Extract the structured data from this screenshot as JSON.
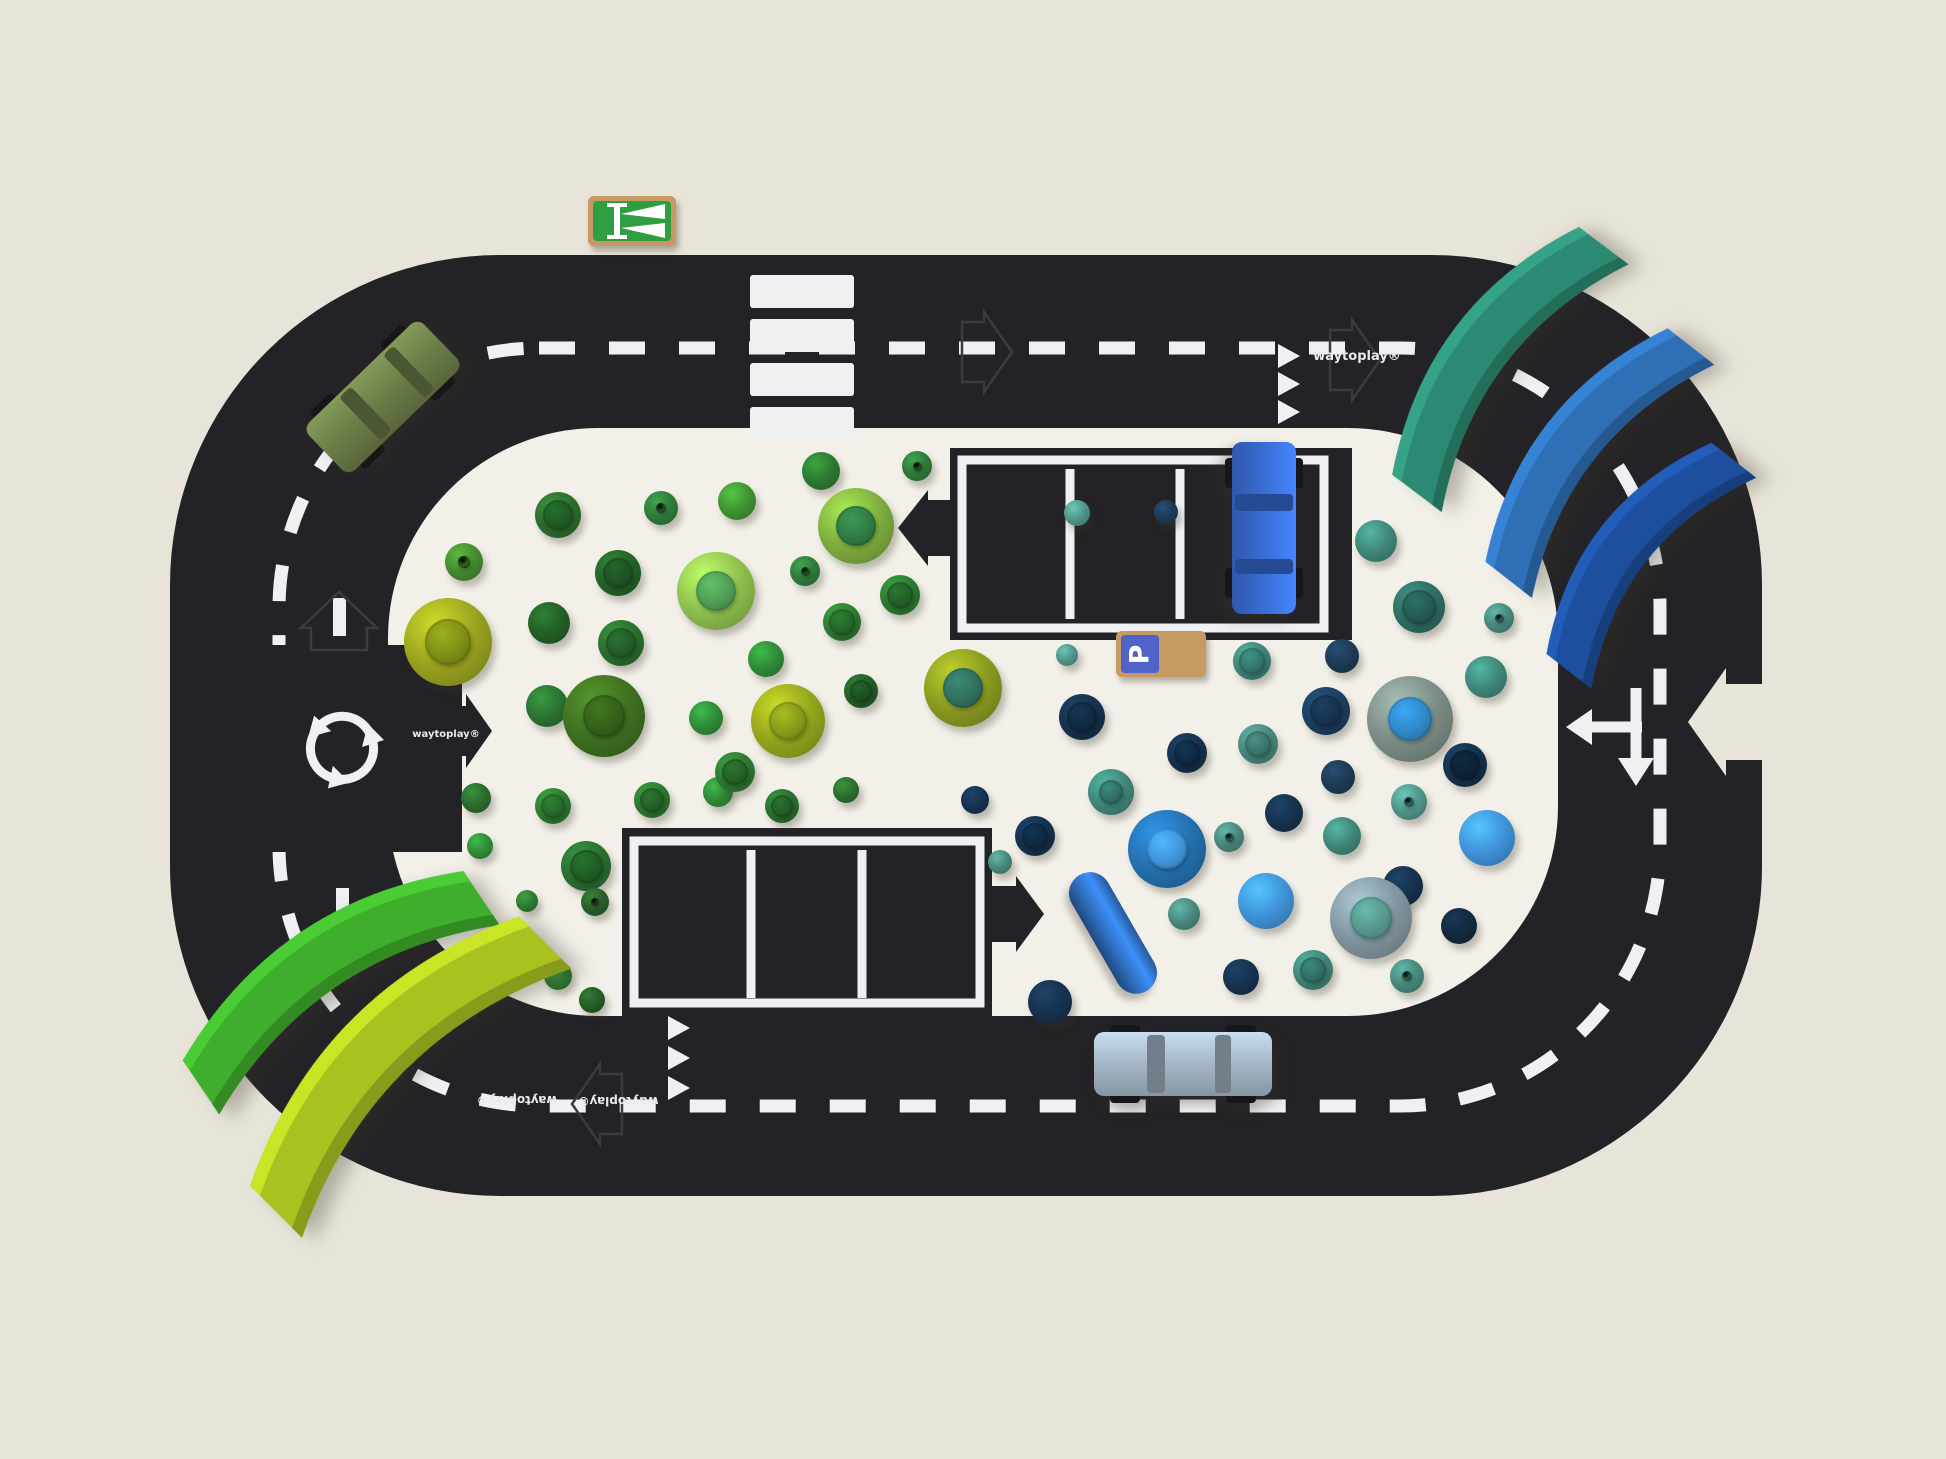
{
  "scene": {
    "background_color": "#e8e4d9",
    "mat_color": "#f2f0e8",
    "road_color": "#232327",
    "marking_color": "#eef0f2",
    "wood_color": "#c79a63"
  },
  "track": {
    "brand": "waytoplay®",
    "features": [
      "zebra-crossing",
      "roundabout",
      "t-junction-arrows",
      "give-way-triangles",
      "dashed-center-line",
      "puzzle-arrow-connectors",
      "parking-lot-top",
      "parking-lot-bottom"
    ]
  },
  "signs": {
    "motorway_sign": {
      "x": 588,
      "y": 196,
      "w": 88,
      "h": 50,
      "face": "#2f9e41"
    },
    "parking_sign": {
      "x": 1116,
      "y": 631,
      "w": 90,
      "h": 46,
      "face": "#4f63c8",
      "letter": "P"
    }
  },
  "toys": {
    "green_pieces": [
      {
        "x": 558,
        "y": 515,
        "r": 23,
        "c": "#2c6e2e",
        "cap": "#1f5a23",
        "t": "mush"
      },
      {
        "x": 661,
        "y": 508,
        "r": 17,
        "c": "#2f7a3a",
        "cap": null,
        "t": "cone"
      },
      {
        "x": 737,
        "y": 501,
        "r": 19,
        "c": "#3f9332",
        "cap": null,
        "t": "ball"
      },
      {
        "x": 821,
        "y": 471,
        "r": 19,
        "c": "#2c7a30",
        "cap": null,
        "t": "ball"
      },
      {
        "x": 856,
        "y": 526,
        "r": 38,
        "c": "#7fae3e",
        "cap": "#2f7a44",
        "t": "bowl"
      },
      {
        "x": 464,
        "y": 562,
        "r": 19,
        "c": "#458a2f",
        "cap": null,
        "t": "cone"
      },
      {
        "x": 618,
        "y": 573,
        "r": 23,
        "c": "#256328",
        "cap": "#1d5222",
        "t": "mush"
      },
      {
        "x": 716,
        "y": 591,
        "r": 39,
        "c": "#8fc04e",
        "cap": "#4f9a55",
        "t": "bowl"
      },
      {
        "x": 805,
        "y": 571,
        "r": 15,
        "c": "#2f7a3a",
        "cap": null,
        "t": "cone"
      },
      {
        "x": 842,
        "y": 622,
        "r": 19,
        "c": "#2e7d32",
        "cap": "#256628",
        "t": "mush"
      },
      {
        "x": 448,
        "y": 642,
        "r": 44,
        "c": "#9aa41f",
        "cap": "#7e8c15",
        "t": "bowl"
      },
      {
        "x": 549,
        "y": 623,
        "r": 21,
        "c": "#235f27",
        "cap": null,
        "t": "ball"
      },
      {
        "x": 621,
        "y": 643,
        "r": 23,
        "c": "#2a7030",
        "cap": "#225c28",
        "t": "mush"
      },
      {
        "x": 766,
        "y": 659,
        "r": 18,
        "c": "#2f8b38",
        "cap": null,
        "t": "ball"
      },
      {
        "x": 861,
        "y": 691,
        "r": 17,
        "c": "#235f27",
        "cap": "#1c5020",
        "t": "mush"
      },
      {
        "x": 547,
        "y": 706,
        "r": 21,
        "c": "#2a7330",
        "cap": null,
        "t": "ball"
      },
      {
        "x": 604,
        "y": 716,
        "r": 41,
        "c": "#3e7020",
        "cap": "#336018",
        "t": "bowl"
      },
      {
        "x": 706,
        "y": 718,
        "r": 17,
        "c": "#2f8b38",
        "cap": null,
        "t": "ball"
      },
      {
        "x": 788,
        "y": 721,
        "r": 37,
        "c": "#96a51d",
        "cap": "#86961a",
        "t": "bowl"
      },
      {
        "x": 900,
        "y": 595,
        "r": 20,
        "c": "#2c7a30",
        "cap": "#235f27",
        "t": "mush"
      },
      {
        "x": 917,
        "y": 466,
        "r": 15,
        "c": "#2f7a3a",
        "cap": null,
        "t": "cone"
      },
      {
        "x": 476,
        "y": 798,
        "r": 15,
        "c": "#2a6b2d",
        "cap": null,
        "t": "ball"
      },
      {
        "x": 553,
        "y": 806,
        "r": 18,
        "c": "#2e7d32",
        "cap": "#266829",
        "t": "mush"
      },
      {
        "x": 480,
        "y": 846,
        "r": 13,
        "c": "#2f8b38",
        "cap": null,
        "t": "ball"
      },
      {
        "x": 586,
        "y": 866,
        "r": 25,
        "c": "#2a7030",
        "cap": "#1f5c25",
        "t": "mush"
      },
      {
        "x": 527,
        "y": 901,
        "r": 11,
        "c": "#2c7a30",
        "cap": null,
        "t": "ball"
      },
      {
        "x": 500,
        "y": 946,
        "r": 16,
        "c": "#235f27",
        "cap": null,
        "t": "ball"
      },
      {
        "x": 558,
        "y": 976,
        "r": 14,
        "c": "#2e7d32",
        "cap": null,
        "t": "ball"
      },
      {
        "x": 462,
        "y": 1000,
        "r": 15,
        "c": "#2f7a3a",
        "cap": null,
        "t": "cone"
      },
      {
        "x": 652,
        "y": 800,
        "r": 18,
        "c": "#2c7a30",
        "cap": "#235f27",
        "t": "mush"
      },
      {
        "x": 718,
        "y": 792,
        "r": 15,
        "c": "#2f8b38",
        "cap": null,
        "t": "ball"
      },
      {
        "x": 782,
        "y": 806,
        "r": 17,
        "c": "#2a7030",
        "cap": "#225c28",
        "t": "mush"
      },
      {
        "x": 846,
        "y": 790,
        "r": 13,
        "c": "#2c6e2e",
        "cap": null,
        "t": "ball"
      },
      {
        "x": 595,
        "y": 902,
        "r": 14,
        "c": "#2a5e2a",
        "cap": null,
        "t": "cone"
      },
      {
        "x": 592,
        "y": 1000,
        "r": 13,
        "c": "#245c26",
        "cap": null,
        "t": "ball"
      },
      {
        "x": 963,
        "y": 688,
        "r": 39,
        "c": "#8c9a20",
        "cap": "#2f6e5e",
        "t": "bowl"
      },
      {
        "x": 735,
        "y": 772,
        "r": 20,
        "c": "#2c7a30",
        "cap": "#235f27",
        "t": "mush"
      }
    ],
    "blue_pieces": [
      {
        "x": 1067,
        "y": 655,
        "r": 11,
        "c": "#4f9488",
        "cap": null,
        "t": "ball"
      },
      {
        "x": 1252,
        "y": 661,
        "r": 19,
        "c": "#3f8779",
        "cap": "#34746a",
        "t": "mush"
      },
      {
        "x": 1342,
        "y": 656,
        "r": 17,
        "c": "#1d3a55",
        "cap": null,
        "t": "ball"
      },
      {
        "x": 1486,
        "y": 677,
        "r": 21,
        "c": "#3f8779",
        "cap": null,
        "t": "ball"
      },
      {
        "x": 1082,
        "y": 717,
        "r": 23,
        "c": "#16324e",
        "cap": "#0f2a42",
        "t": "mush"
      },
      {
        "x": 1326,
        "y": 711,
        "r": 24,
        "c": "#1d3f60",
        "cap": "#16324e",
        "t": "mush"
      },
      {
        "x": 1410,
        "y": 719,
        "r": 43,
        "c": "#7b8d86",
        "cap": "#2f86c4",
        "t": "bowl"
      },
      {
        "x": 1187,
        "y": 753,
        "r": 20,
        "c": "#16324e",
        "cap": "#0f2a42",
        "t": "mush"
      },
      {
        "x": 1258,
        "y": 744,
        "r": 20,
        "c": "#48887c",
        "cap": "#3a7469",
        "t": "mush"
      },
      {
        "x": 1338,
        "y": 777,
        "r": 17,
        "c": "#1d3a55",
        "cap": null,
        "t": "ball"
      },
      {
        "x": 1465,
        "y": 765,
        "r": 22,
        "c": "#16324e",
        "cap": "#0c2235",
        "t": "mush"
      },
      {
        "x": 1111,
        "y": 792,
        "r": 23,
        "c": "#3f8779",
        "cap": "#2f6e62",
        "t": "bowl"
      },
      {
        "x": 1284,
        "y": 813,
        "r": 19,
        "c": "#16324e",
        "cap": null,
        "t": "ball"
      },
      {
        "x": 1409,
        "y": 802,
        "r": 18,
        "c": "#4f9488",
        "cap": null,
        "t": "cone"
      },
      {
        "x": 1342,
        "y": 836,
        "r": 19,
        "c": "#3f8779",
        "cap": null,
        "t": "ball"
      },
      {
        "x": 1487,
        "y": 838,
        "r": 28,
        "c": "#3f93d9",
        "cap": null,
        "t": "ball"
      },
      {
        "x": 1167,
        "y": 849,
        "r": 39,
        "c": "#2470ae",
        "cap": "#3f93d9",
        "t": "bowl"
      },
      {
        "x": 1229,
        "y": 837,
        "r": 15,
        "c": "#48887c",
        "cap": null,
        "t": "cone"
      },
      {
        "x": 1035,
        "y": 836,
        "r": 20,
        "c": "#16324e",
        "cap": "#0f2a42",
        "t": "mush"
      },
      {
        "x": 1403,
        "y": 886,
        "r": 20,
        "c": "#16324e",
        "cap": null,
        "t": "ball"
      },
      {
        "x": 1184,
        "y": 914,
        "r": 16,
        "c": "#48887c",
        "cap": null,
        "t": "ball"
      },
      {
        "x": 1266,
        "y": 901,
        "r": 28,
        "c": "#3f93d9",
        "cap": null,
        "t": "ball"
      },
      {
        "x": 1371,
        "y": 918,
        "r": 41,
        "c": "#8195a0",
        "cap": "#55958a",
        "t": "bowl"
      },
      {
        "x": 1459,
        "y": 926,
        "r": 18,
        "c": "#13293f",
        "cap": null,
        "t": "ball"
      },
      {
        "x": 1313,
        "y": 970,
        "r": 20,
        "c": "#3f8779",
        "cap": "#2f6e62",
        "t": "mush"
      },
      {
        "x": 1241,
        "y": 977,
        "r": 18,
        "c": "#16324e",
        "cap": null,
        "t": "ball"
      },
      {
        "x": 1407,
        "y": 976,
        "r": 17,
        "c": "#48887c",
        "cap": null,
        "t": "cone"
      },
      {
        "x": 1050,
        "y": 1002,
        "r": 22,
        "c": "#16324e",
        "cap": null,
        "t": "ball"
      },
      {
        "x": 1376,
        "y": 541,
        "r": 21,
        "c": "#3f8779",
        "cap": null,
        "t": "ball"
      },
      {
        "x": 1419,
        "y": 607,
        "r": 26,
        "c": "#2f6e62",
        "cap": "#255a50",
        "t": "mush"
      },
      {
        "x": 1499,
        "y": 618,
        "r": 15,
        "c": "#48887c",
        "cap": null,
        "t": "cone"
      },
      {
        "x": 1077,
        "y": 513,
        "r": 13,
        "c": "#4f9488",
        "cap": null,
        "t": "ball"
      },
      {
        "x": 1166,
        "y": 512,
        "r": 12,
        "c": "#1d3a55",
        "cap": null,
        "t": "ball"
      },
      {
        "x": 975,
        "y": 800,
        "r": 14,
        "c": "#16324e",
        "cap": null,
        "t": "ball"
      },
      {
        "x": 1000,
        "y": 862,
        "r": 12,
        "c": "#48887c",
        "cap": null,
        "t": "ball"
      }
    ],
    "cylinder": {
      "x": 1113,
      "y": 933,
      "len": 134,
      "thick": 42,
      "rot": 60,
      "c": "#2f6fc0"
    }
  },
  "cars": [
    {
      "name": "olive-green-car",
      "x": 383,
      "y": 397,
      "len": 160,
      "wid": 66,
      "rot": -44,
      "body": "#6e8049"
    },
    {
      "name": "blue-car",
      "x": 1264,
      "y": 528,
      "len": 172,
      "wid": 64,
      "rot": 90,
      "body": "#3a6fd8"
    },
    {
      "name": "gray-blue-car",
      "x": 1183,
      "y": 1064,
      "len": 178,
      "wid": 64,
      "rot": 0,
      "body": "#a7bac9"
    }
  ],
  "arches": [
    {
      "name": "navy-arch",
      "x": 1637,
      "y": 555,
      "w": 285,
      "h": 108,
      "rot": -52,
      "c": "#1d4f9e"
    },
    {
      "name": "blue-arch",
      "x": 1585,
      "y": 452,
      "w": 315,
      "h": 112,
      "rot": -52,
      "c": "#2e6fb5"
    },
    {
      "name": "teal-arch",
      "x": 1495,
      "y": 358,
      "w": 330,
      "h": 118,
      "rot": -53,
      "c": "#2c8a72"
    },
    {
      "name": "green-arch",
      "x": 330,
      "y": 976,
      "w": 360,
      "h": 124,
      "rot": -34,
      "c": "#3fae2c"
    },
    {
      "name": "lime-arch",
      "x": 394,
      "y": 1061,
      "w": 405,
      "h": 140,
      "rot": -45,
      "c": "#aac220"
    }
  ]
}
